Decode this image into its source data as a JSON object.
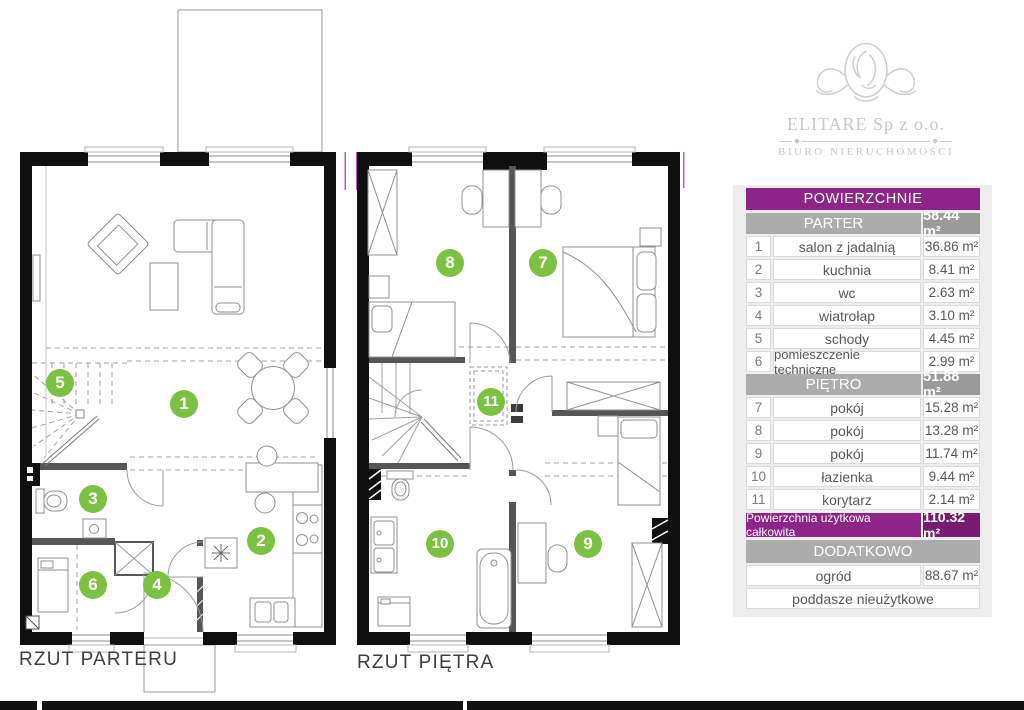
{
  "logo": {
    "company": "ELITARE Sp z o.o.",
    "subtitle": "BIURO NIERUCHOMOŚCI"
  },
  "plans": [
    {
      "label": "RZUT PARTERU",
      "rooms": [
        "1",
        "2",
        "3",
        "4",
        "5",
        "6"
      ]
    },
    {
      "label": "RZUT PIĘTRA",
      "rooms": [
        "7",
        "8",
        "9",
        "10",
        "11"
      ]
    }
  ],
  "table": {
    "title": "POWIERZCHNIE",
    "sections": [
      {
        "header": "PARTER",
        "area": "58.44 m²",
        "rows": [
          {
            "no": "1",
            "name": "salon z jadalnią",
            "area": "36.86 m²"
          },
          {
            "no": "2",
            "name": "kuchnia",
            "area": "8.41 m²"
          },
          {
            "no": "3",
            "name": "wc",
            "area": "2.63 m²"
          },
          {
            "no": "4",
            "name": "wiatrołap",
            "area": "3.10 m²"
          },
          {
            "no": "5",
            "name": "schody",
            "area": "4.45 m²"
          },
          {
            "no": "6",
            "name": "pomieszczenie techniczne",
            "area": "2.99 m²"
          }
        ]
      },
      {
        "header": "PIĘTRO",
        "area": "51.88 m²",
        "rows": [
          {
            "no": "7",
            "name": "pokój",
            "area": "15.28 m²"
          },
          {
            "no": "8",
            "name": "pokój",
            "area": "13.28 m²"
          },
          {
            "no": "9",
            "name": "pokój",
            "area": "11.74 m²"
          },
          {
            "no": "10",
            "name": "łazienka",
            "area": "9.44 m²"
          },
          {
            "no": "11",
            "name": "korytarz",
            "area": "2.14 m²"
          }
        ]
      }
    ],
    "total": {
      "label": "Powierzchnia użytkowa całkowita",
      "area": "110.32 m²"
    },
    "additional": {
      "header": "DODATKOWO",
      "rows": [
        {
          "name": "ogród",
          "area": "88.67 m²"
        },
        {
          "name": "poddasze nieużytkowe",
          "area": ""
        }
      ]
    }
  },
  "colors": {
    "accent_purple": "#8E2388",
    "accent_purple_dark": "#781C72",
    "accent_green": "#7CC142",
    "header_gray": "#ACACAC"
  }
}
